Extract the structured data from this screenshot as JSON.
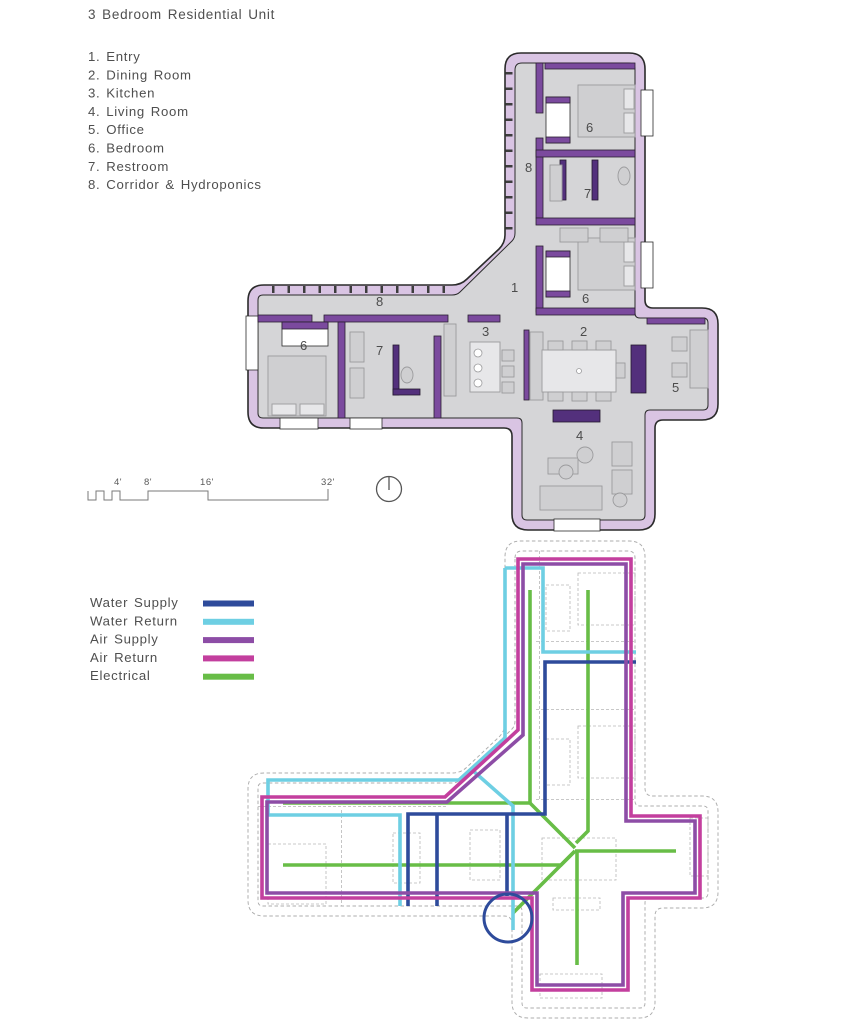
{
  "title": "3 Bedroom Residential Unit",
  "room_list": {
    "items": [
      {
        "display": "1. Entry"
      },
      {
        "display": "2. Dining Room"
      },
      {
        "display": "3. Kitchen"
      },
      {
        "display": "4. Living Room"
      },
      {
        "display": "5. Office"
      },
      {
        "display": "6. Bedroom"
      },
      {
        "display": "7. Restroom"
      },
      {
        "display": "8. Corridor & Hydroponics"
      }
    ]
  },
  "floor_plan": {
    "room_numbers": {
      "entry": "1",
      "dining": "2",
      "kitchen": "3",
      "living": "4",
      "office": "5",
      "bedroom": "6",
      "restroom": "7",
      "corridor": "8"
    }
  },
  "scale_bar": {
    "labels": [
      "4'",
      "8'",
      "16'",
      "32'"
    ]
  },
  "mep_legend": {
    "items": [
      {
        "label": "Water Supply",
        "color": "#2e4b9b"
      },
      {
        "label": "Water Return",
        "color": "#6ecfe3"
      },
      {
        "label": "Air Supply",
        "color": "#8d4da6"
      },
      {
        "label": "Air Return",
        "color": "#c33f9e"
      },
      {
        "label": "Electrical",
        "color": "#68bd47"
      }
    ]
  },
  "plan_colors": {
    "outer_wall": "#d9c4e3",
    "interior_wall": "#7b4a9e",
    "interior_wall_dark": "#53307c",
    "floor": "#d5d5d7",
    "outline": "#2b2b2b"
  }
}
